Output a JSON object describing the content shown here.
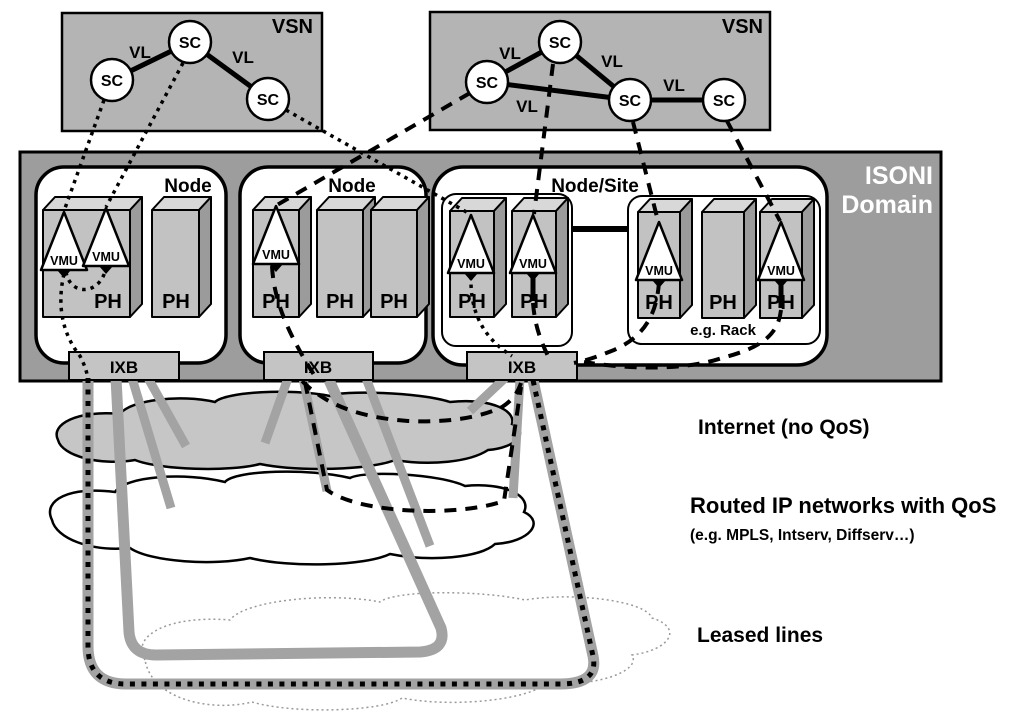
{
  "labels": {
    "vsn": "VSN",
    "sc": "SC",
    "vl": "VL",
    "node": "Node",
    "node_site": "Node/Site",
    "ph": "PH",
    "vmu": "VMU",
    "ixb": "IXB",
    "rack": "e.g. Rack",
    "isoni_line1": "ISONI",
    "isoni_line2": "Domain"
  },
  "legend": {
    "internet": "Internet (no QoS)",
    "routed": "Routed IP networks with QoS",
    "routed_sub": "(e.g. MPLS, Intserv, Diffserv…)",
    "leased": "Leased lines"
  },
  "colors": {
    "vsn_fill": "#b4b4b4",
    "domain_fill": "#9d9d9d",
    "node_fill": "#ffffff",
    "ph_front": "#c2c2c2",
    "ph_top": "#d8d8d8",
    "ph_side": "#9b9b9b",
    "ixb_fill": "#c4c4c4",
    "cloud_gray": "#c6c6c6",
    "line_gray": "#a3a3a3"
  },
  "structure": {
    "vsn_left": {
      "service_components": 3,
      "virtual_links": 2
    },
    "vsn_right": {
      "service_components": 4,
      "virtual_links": 4
    },
    "isoni_domain": {
      "nodes": [
        {
          "label": "Node",
          "ph_count": 2,
          "vmu_count": 2,
          "ixb": "IXB"
        },
        {
          "label": "Node",
          "ph_count": 3,
          "vmu_count": 1,
          "ixb": "IXB"
        },
        {
          "label": "Node/Site",
          "ixb": "IXB",
          "groups": [
            {
              "ph_count": 2,
              "vmu_count": 2
            },
            {
              "label": "e.g. Rack",
              "ph_count": 3,
              "vmu_count": 2
            }
          ]
        }
      ]
    },
    "transport_layers": [
      "Internet (no QoS)",
      "Routed IP networks with QoS",
      "Leased lines"
    ]
  }
}
